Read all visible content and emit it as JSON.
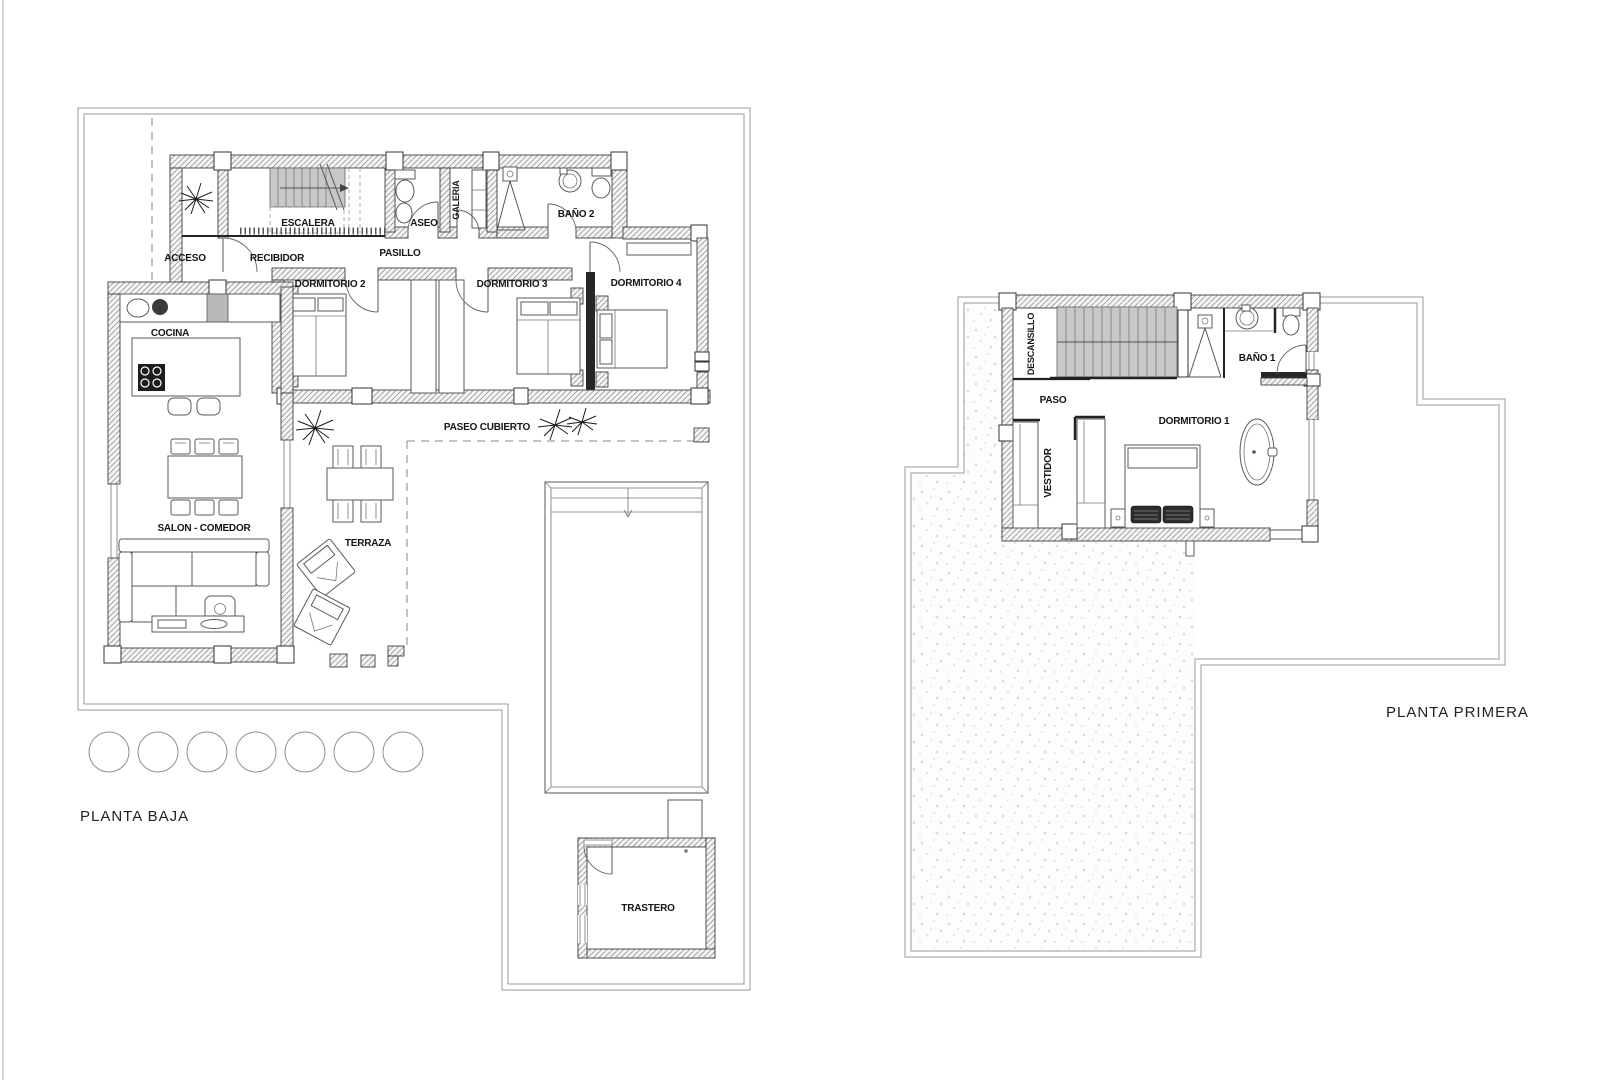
{
  "ground_floor": {
    "title": "PLANTA BAJA",
    "rooms": {
      "acceso": "ACCESO",
      "recibidor": "RECIBIDOR",
      "escalera": "ESCALERA",
      "aseo": "ASEO",
      "galeria": "GALERIA",
      "bano2": "BAÑO 2",
      "pasillo": "PASILLO",
      "dormitorio2": "DORMITORIO 2",
      "dormitorio3": "DORMITORIO 3",
      "dormitorio4": "DORMITORIO 4",
      "cocina": "COCINA",
      "salon_comedor": "SALON - COMEDOR",
      "terraza": "TERRAZA",
      "paseo_cubierto": "PASEO CUBIERTO",
      "trastero": "TRASTERO"
    }
  },
  "first_floor": {
    "title": "PLANTA PRIMERA",
    "rooms": {
      "descansillo": "DESCANSILLO",
      "paso": "PASO",
      "bano1": "BAÑO 1",
      "dormitorio1": "DORMITORIO 1",
      "vestidor": "VESTIDOR"
    }
  }
}
